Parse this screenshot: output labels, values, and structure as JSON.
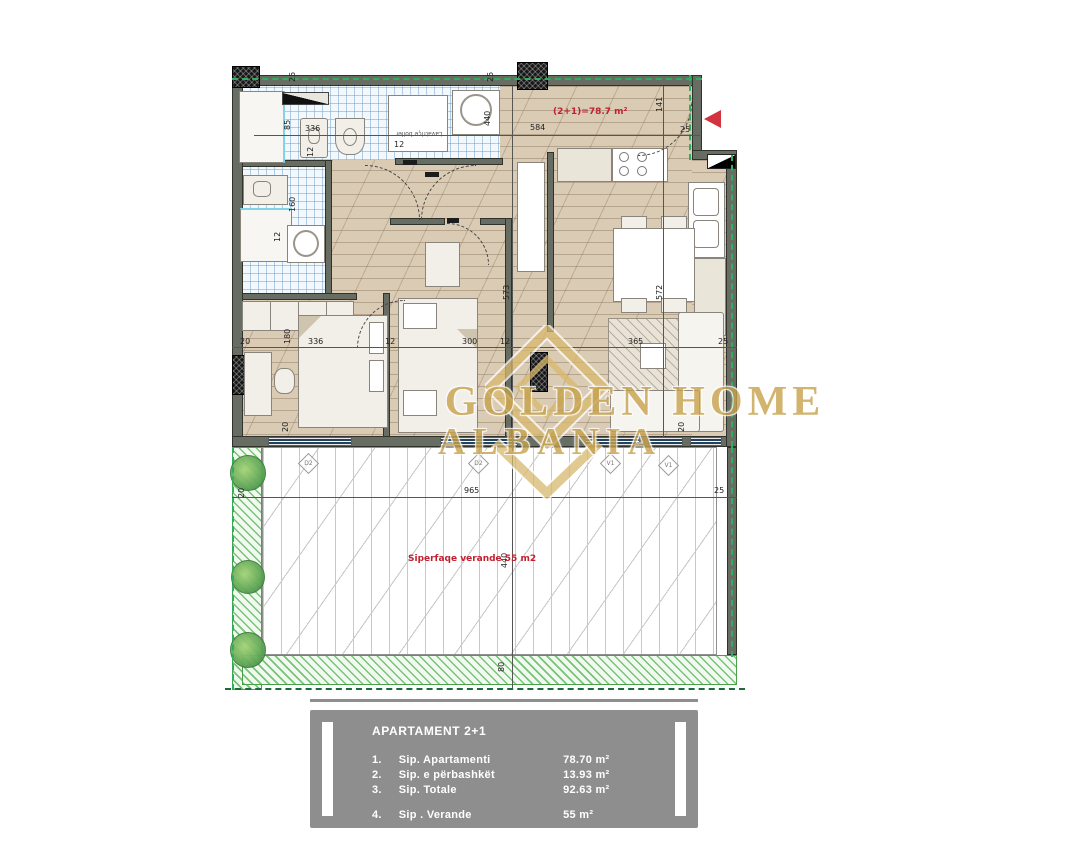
{
  "watermark": {
    "line1": "GOLDEN HOME",
    "line2": "ALBANIA"
  },
  "labels": {
    "apartment_area": "(2+1)=78.7 m²",
    "veranda_area": "Siperfaqe verande 55 m2",
    "washer_box": "Lavatriçe boiler"
  },
  "dims": {
    "top_25a": "25",
    "top_25b": "25",
    "top_height": "440",
    "top_width": "584",
    "entry_141": "141",
    "entry_25": "25",
    "bath_85": "85",
    "bath_336": "336",
    "bath_12a": "12",
    "bath_12b": "12",
    "bath_160": "160",
    "bath_12c": "12",
    "chain_20": "20",
    "chain_180": "180",
    "chain_336": "336",
    "chain_12a": "12",
    "chain_300": "300",
    "chain_12b": "12",
    "chain_365": "365",
    "chain_25": "25",
    "corr_573": "573",
    "kit_572": "572",
    "win_20a": "20",
    "win_20b": "20",
    "ver_20": "20",
    "ver_965": "965",
    "ver_440": "440",
    "ver_80": "80",
    "ver_25": "25"
  },
  "window_tags": {
    "w1": "D2",
    "w2": "D2",
    "w3": "V1",
    "w4": "V1"
  },
  "info_table": {
    "title": "APARTAMENT 2+1",
    "rows": [
      {
        "num": "1.",
        "label": "Sip. Apartamenti",
        "value": "78.70  m²"
      },
      {
        "num": "2.",
        "label": "Sip. e përbashkët",
        "value": "13.93  m²"
      },
      {
        "num": "3.",
        "label": "Sip. Totale",
        "value": "92.63  m²"
      },
      {
        "num": "4.",
        "label": "Sip . Verande",
        "value": "55  m²"
      }
    ]
  },
  "colors": {
    "accent_red": "#c2202f",
    "wall": "#686d63",
    "gold": "#c7a24c",
    "boundary_green": "#2fae5e"
  }
}
